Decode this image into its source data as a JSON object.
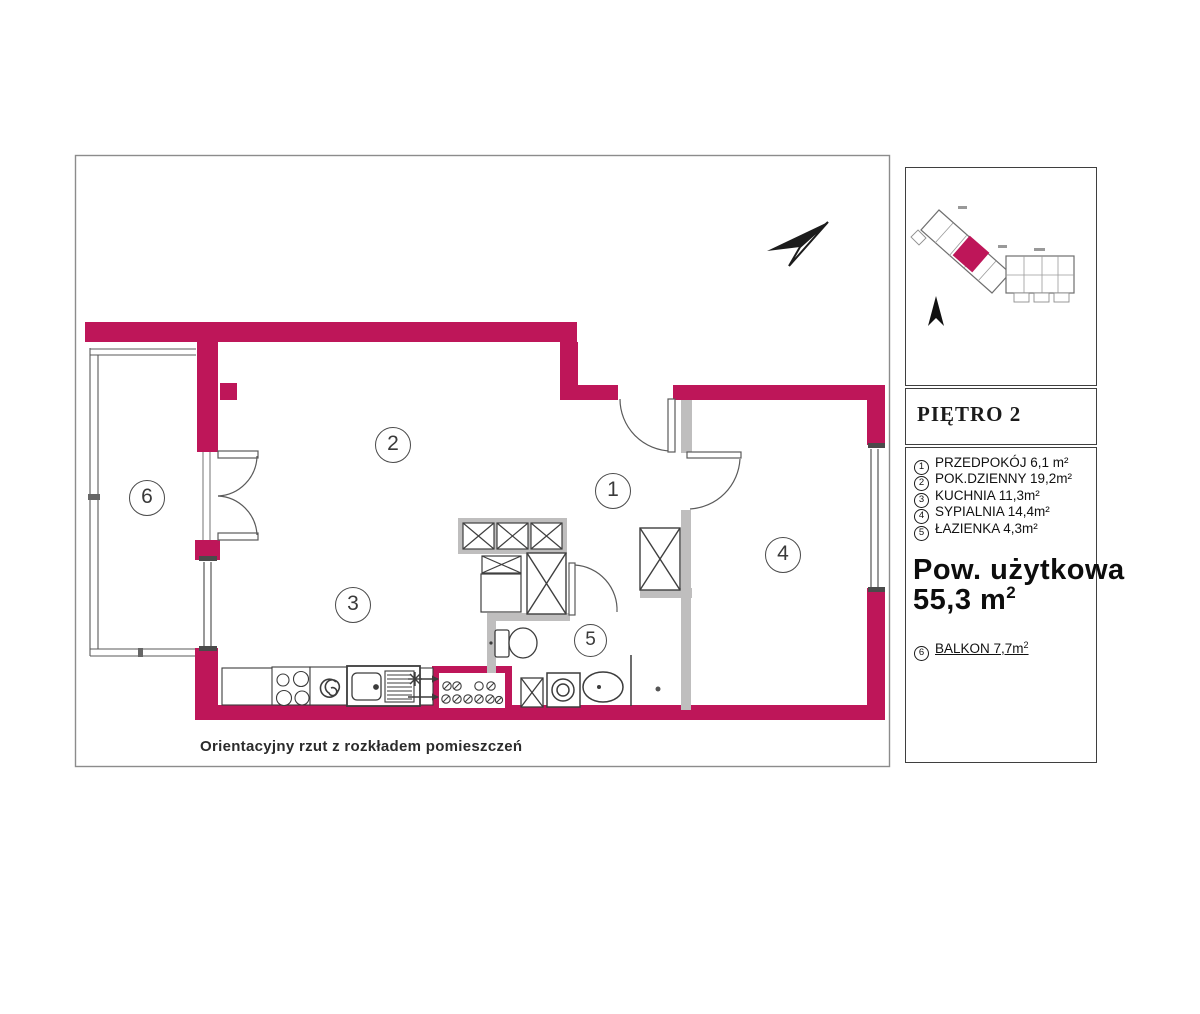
{
  "colors": {
    "wall": "#BE1659",
    "gray_wall": "#BFBEBE",
    "line": "#444444"
  },
  "plan": {
    "caption": "Orientacyjny rzut z rozkładem pomieszczeń",
    "markers": [
      {
        "n": "1"
      },
      {
        "n": "2"
      },
      {
        "n": "3"
      },
      {
        "n": "4"
      },
      {
        "n": "5"
      },
      {
        "n": "6"
      }
    ]
  },
  "panel": {
    "floor_label": "PIĘTRO 2",
    "rooms": [
      {
        "num": "1",
        "label": "PRZEDPOKÓJ  6,1 m²"
      },
      {
        "num": "2",
        "label": "POK.DZIENNY 19,2m²"
      },
      {
        "num": "3",
        "label": "KUCHNIA 11,3m²"
      },
      {
        "num": "4",
        "label": "SYPIALNIA 14,4m²"
      },
      {
        "num": "5",
        "label": "ŁAZIENKA 4,3m²"
      }
    ],
    "total_label": "Pow. użytkowa",
    "total_value": "55,3 m",
    "total_sup": "2",
    "balcony": {
      "num": "6",
      "label": "BALKON  7,7m",
      "sup": "2"
    }
  }
}
